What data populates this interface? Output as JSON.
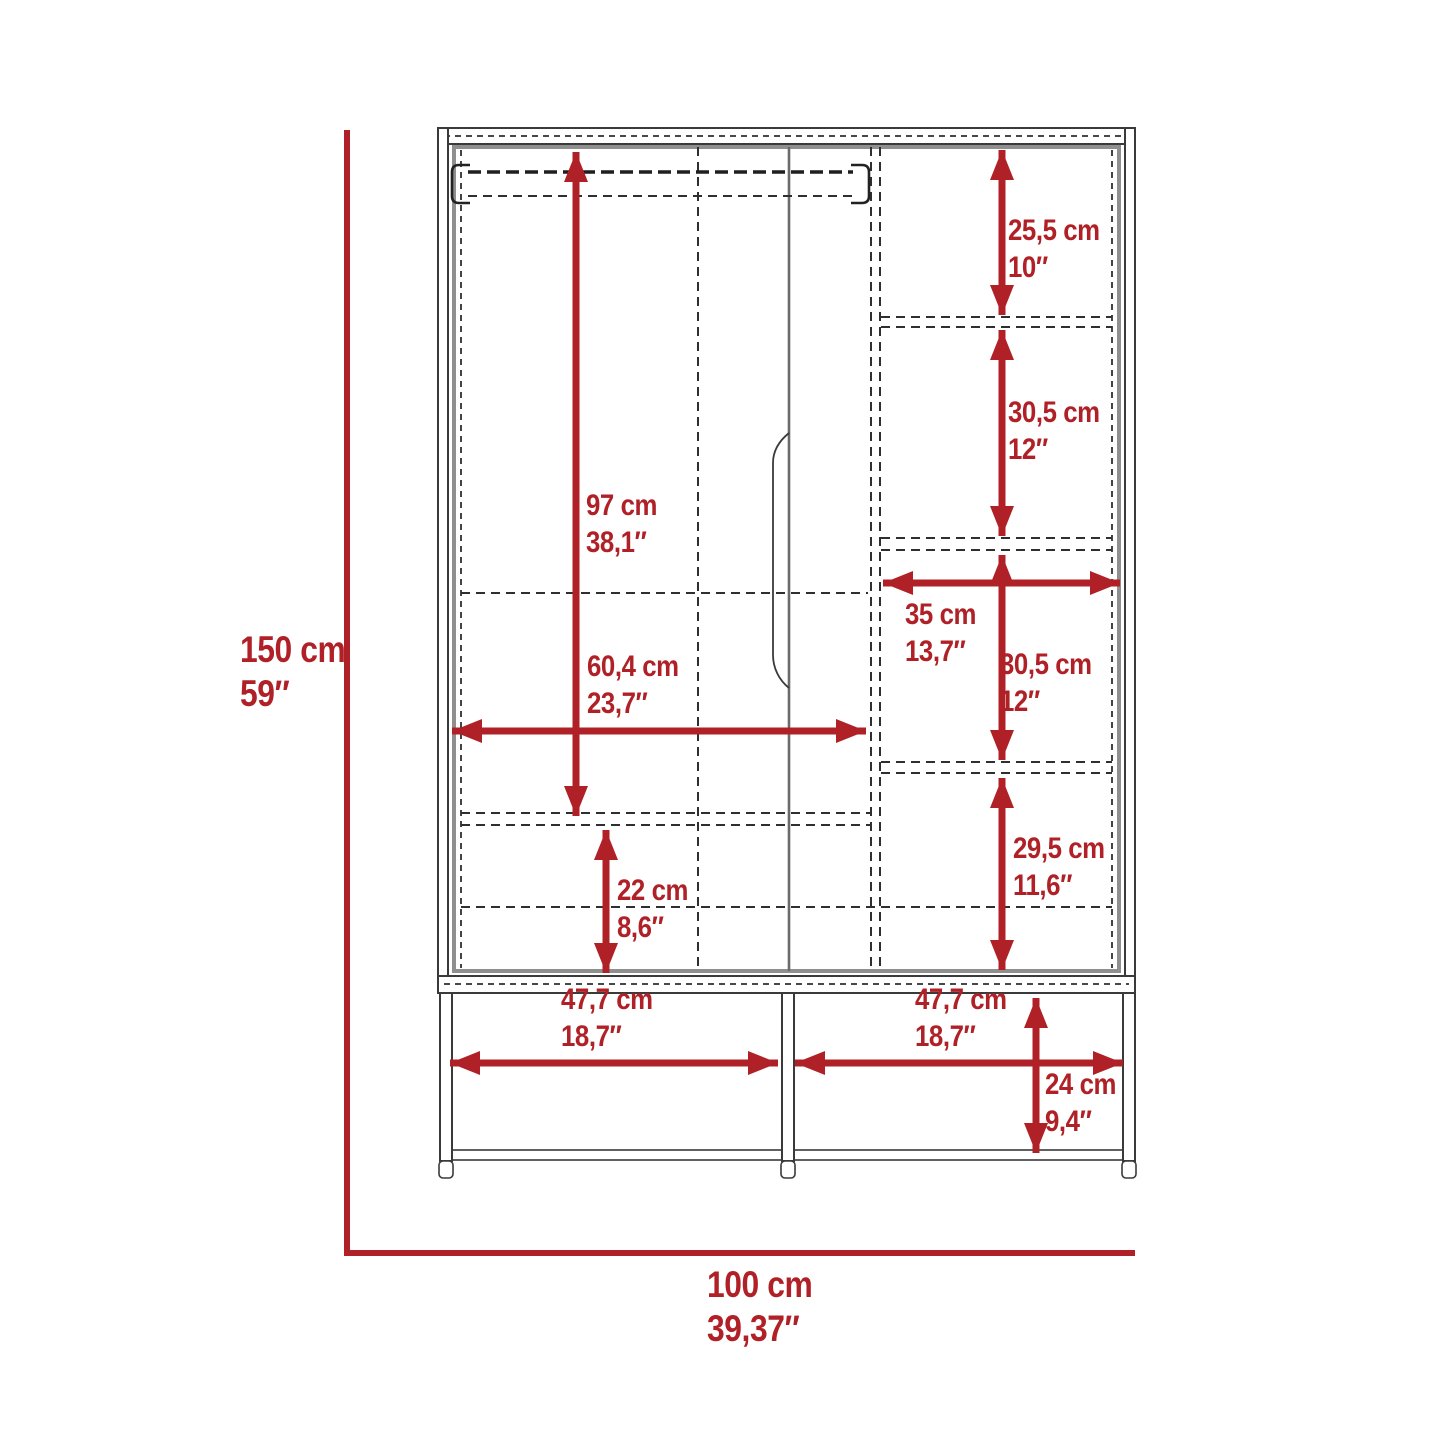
{
  "diagram": {
    "type": "furniture-dimension-diagram",
    "subject": "three-door wardrobe armoire with open bottom shelf, front elevation with dimension callouts"
  },
  "colors": {
    "dimension_red": "#b02127",
    "line_dark": "#3a3a3a",
    "line_mid": "#6b6b6b",
    "line_gray": "#8f8f8f",
    "background": "#ffffff"
  },
  "dims": {
    "overall_height": {
      "cm": "150 cm",
      "in": "59″"
    },
    "overall_width": {
      "cm": "100 cm",
      "in": "39,37″"
    },
    "hanging_height": {
      "cm": "97 cm",
      "in": "38,1″"
    },
    "left_interior_width": {
      "cm": "60,4 cm",
      "in": "23,7″"
    },
    "lower_drawer_height": {
      "cm": "22 cm",
      "in": "8,6″"
    },
    "shelf_1_height": {
      "cm": "25,5 cm",
      "in": "10″"
    },
    "shelf_2_height": {
      "cm": "30,5 cm",
      "in": "12″"
    },
    "right_column_width": {
      "cm": "35 cm",
      "in": "13,7″"
    },
    "shelf_3_height": {
      "cm": "30,5 cm",
      "in": "12″"
    },
    "shelf_4_height": {
      "cm": "29,5 cm",
      "in": "11,6″"
    },
    "base_left_width": {
      "cm": "47,7 cm",
      "in": "18,7″"
    },
    "base_right_width": {
      "cm": "47,7 cm",
      "in": "18,7″"
    },
    "base_height": {
      "cm": "24 cm",
      "in": "9,4″"
    }
  }
}
